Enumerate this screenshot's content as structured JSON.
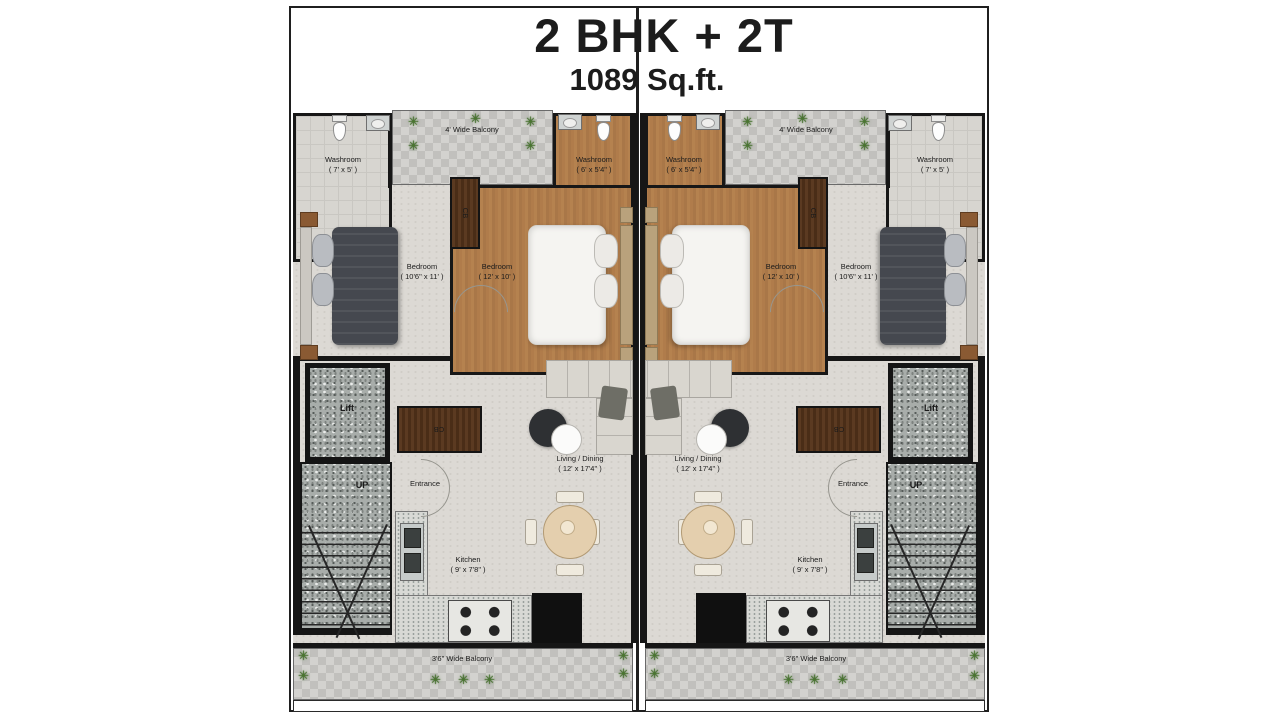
{
  "title": {
    "line1": "2 BHK + 2T",
    "line2": "1089 Sq.ft."
  },
  "icons": {
    "plant": "✳"
  },
  "colors": {
    "wall": "#161616",
    "wood_floor": "#b07c4b",
    "dark_wood": "#53341d",
    "granite": "#a8adaa",
    "floor": "#dcd9d4",
    "balcony_paving": "#cac9c6"
  },
  "units": [
    {
      "name": "left unit",
      "washroom_outer": {
        "label": "Washroom",
        "dims": "( 7' x 5' )"
      },
      "washroom_inner": {
        "label": "Washroom",
        "dims": "( 6' x 5'4\" )"
      },
      "balcony_top": {
        "label": "4' Wide Balcony"
      },
      "bedroom_outer": {
        "label": "Bedroom",
        "dims": "( 10'6\" x 11' )"
      },
      "bedroom_inner": {
        "label": "Bedroom",
        "dims": "( 12' x 10' )"
      },
      "living": {
        "label": "Living / Dining",
        "dims": "( 12' x 17'4\" )"
      },
      "kitchen": {
        "label": "Kitchen",
        "dims": "( 9' x 7'8\" )"
      },
      "lift": {
        "label": "Lift"
      },
      "stairs": {
        "label": "UP"
      },
      "entrance": {
        "label": "Entrance"
      },
      "wardrobe": {
        "label": "CB"
      },
      "console": {
        "label": "CB"
      },
      "balcony_bottom": {
        "label": "3'6\" Wide Balcony"
      }
    },
    {
      "name": "right unit",
      "washroom_outer": {
        "label": "Washroom",
        "dims": "( 7' x 5' )"
      },
      "washroom_inner": {
        "label": "Washroom",
        "dims": "( 6' x 5'4\" )"
      },
      "balcony_top": {
        "label": "4' Wide Balcony"
      },
      "bedroom_outer": {
        "label": "Bedroom",
        "dims": "( 10'6\" x 11' )"
      },
      "bedroom_inner": {
        "label": "Bedroom",
        "dims": "( 12' x 10' )"
      },
      "living": {
        "label": "Living / Dining",
        "dims": "( 12' x 17'4\" )"
      },
      "kitchen": {
        "label": "Kitchen",
        "dims": "( 9' x 7'8\" )"
      },
      "lift": {
        "label": "Lift"
      },
      "stairs": {
        "label": "UP"
      },
      "entrance": {
        "label": "Entrance"
      },
      "wardrobe": {
        "label": "CB"
      },
      "console": {
        "label": "CB"
      },
      "balcony_bottom": {
        "label": "3'6\" Wide Balcony"
      }
    }
  ]
}
